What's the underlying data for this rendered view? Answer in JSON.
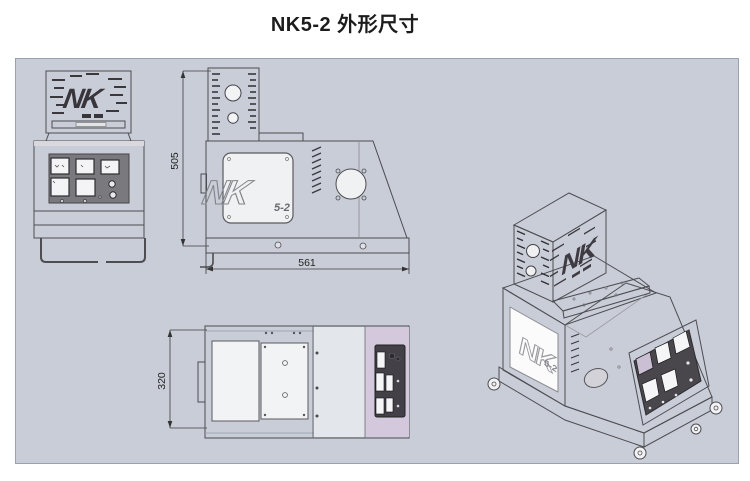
{
  "title": "NK5-2 外形尺寸",
  "model": "NK5-2",
  "dimensions": {
    "height": "505",
    "width": "561",
    "depth": "320"
  },
  "logo": {
    "main": "NK",
    "model": "5-2"
  },
  "views": [
    "front",
    "side",
    "top",
    "isometric"
  ],
  "colors": {
    "canvas_bg": "#c9cdd7",
    "machine_body": "#f2f2f4",
    "panel_dark": "#49464c",
    "front_panel_gray": "#7a7a7e",
    "accent_lavender": "#d5c9dd",
    "outline": "#4d4d52"
  }
}
